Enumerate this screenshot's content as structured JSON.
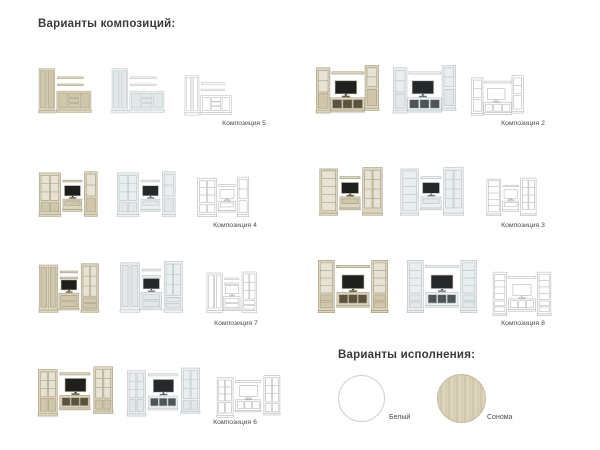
{
  "headings": {
    "compositions": "Варианты композиций:",
    "finishes": "Варианты исполнения:"
  },
  "compositions": [
    {
      "name": "Композиция 5"
    },
    {
      "name": "Композиция 2"
    },
    {
      "name": "Композиция 4"
    },
    {
      "name": "Композиция 3"
    },
    {
      "name": "Композиция 7"
    },
    {
      "name": "Композиция 8"
    },
    {
      "name": "Композиция 6"
    }
  ],
  "render_variants": [
    "sonoma",
    "white",
    "outline-drawing"
  ],
  "finishes": [
    {
      "name": "Белый",
      "color": "#ffffff"
    },
    {
      "name": "Сонома",
      "color": "#d6cdb2"
    }
  ],
  "palette": {
    "heading_text": "#3a3a3a",
    "caption_text": "#4c4c4c",
    "sonoma_wood": "#d8d0b8",
    "white_furniture": "#eef1f2",
    "outline_stroke": "#a6a6a6",
    "tv_screen": "#1f1f1e"
  }
}
